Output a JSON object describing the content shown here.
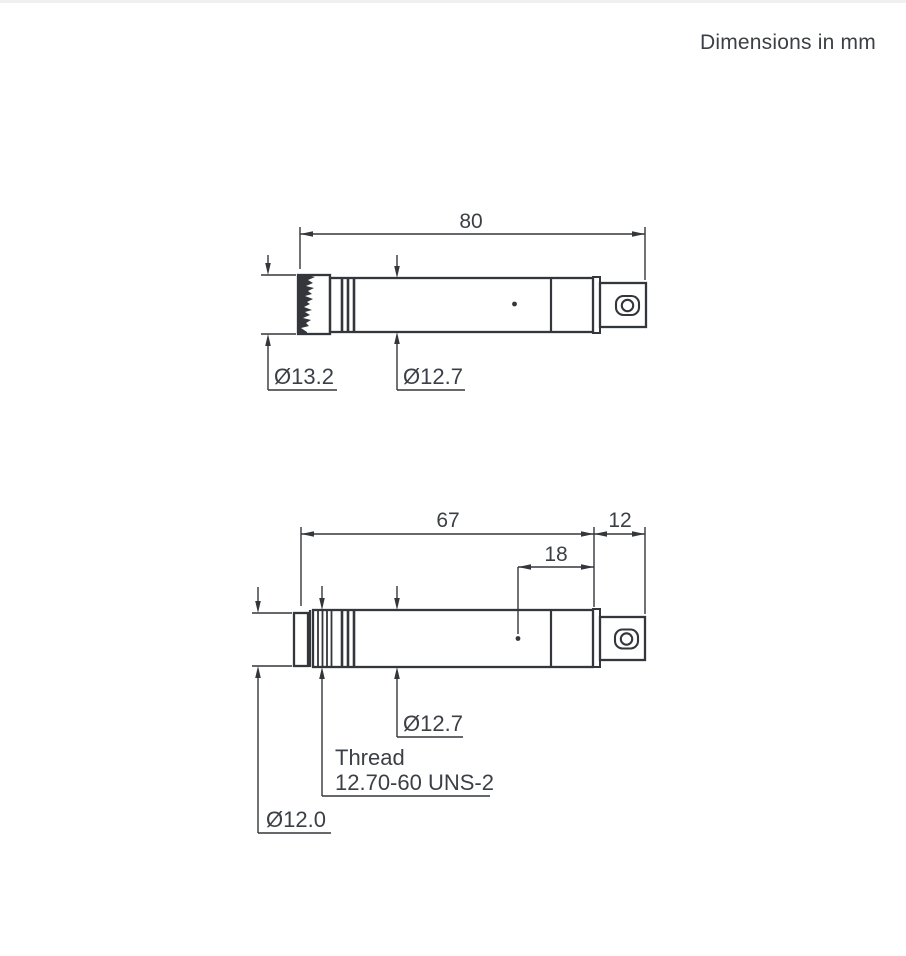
{
  "note": "Dimensions in mm",
  "units": "mm",
  "views": {
    "with_grid": {
      "overall_length": "80",
      "grid_diameter": "Ø13.2",
      "body_diameter": "Ø12.7"
    },
    "without_grid": {
      "body_length": "67",
      "connector_length": "12",
      "vent_distance": "18",
      "body_diameter": "Ø12.7",
      "thread_line1": "Thread",
      "thread_line2": "12.70-60 UNS-2",
      "front_diameter": "Ø12.0"
    }
  }
}
